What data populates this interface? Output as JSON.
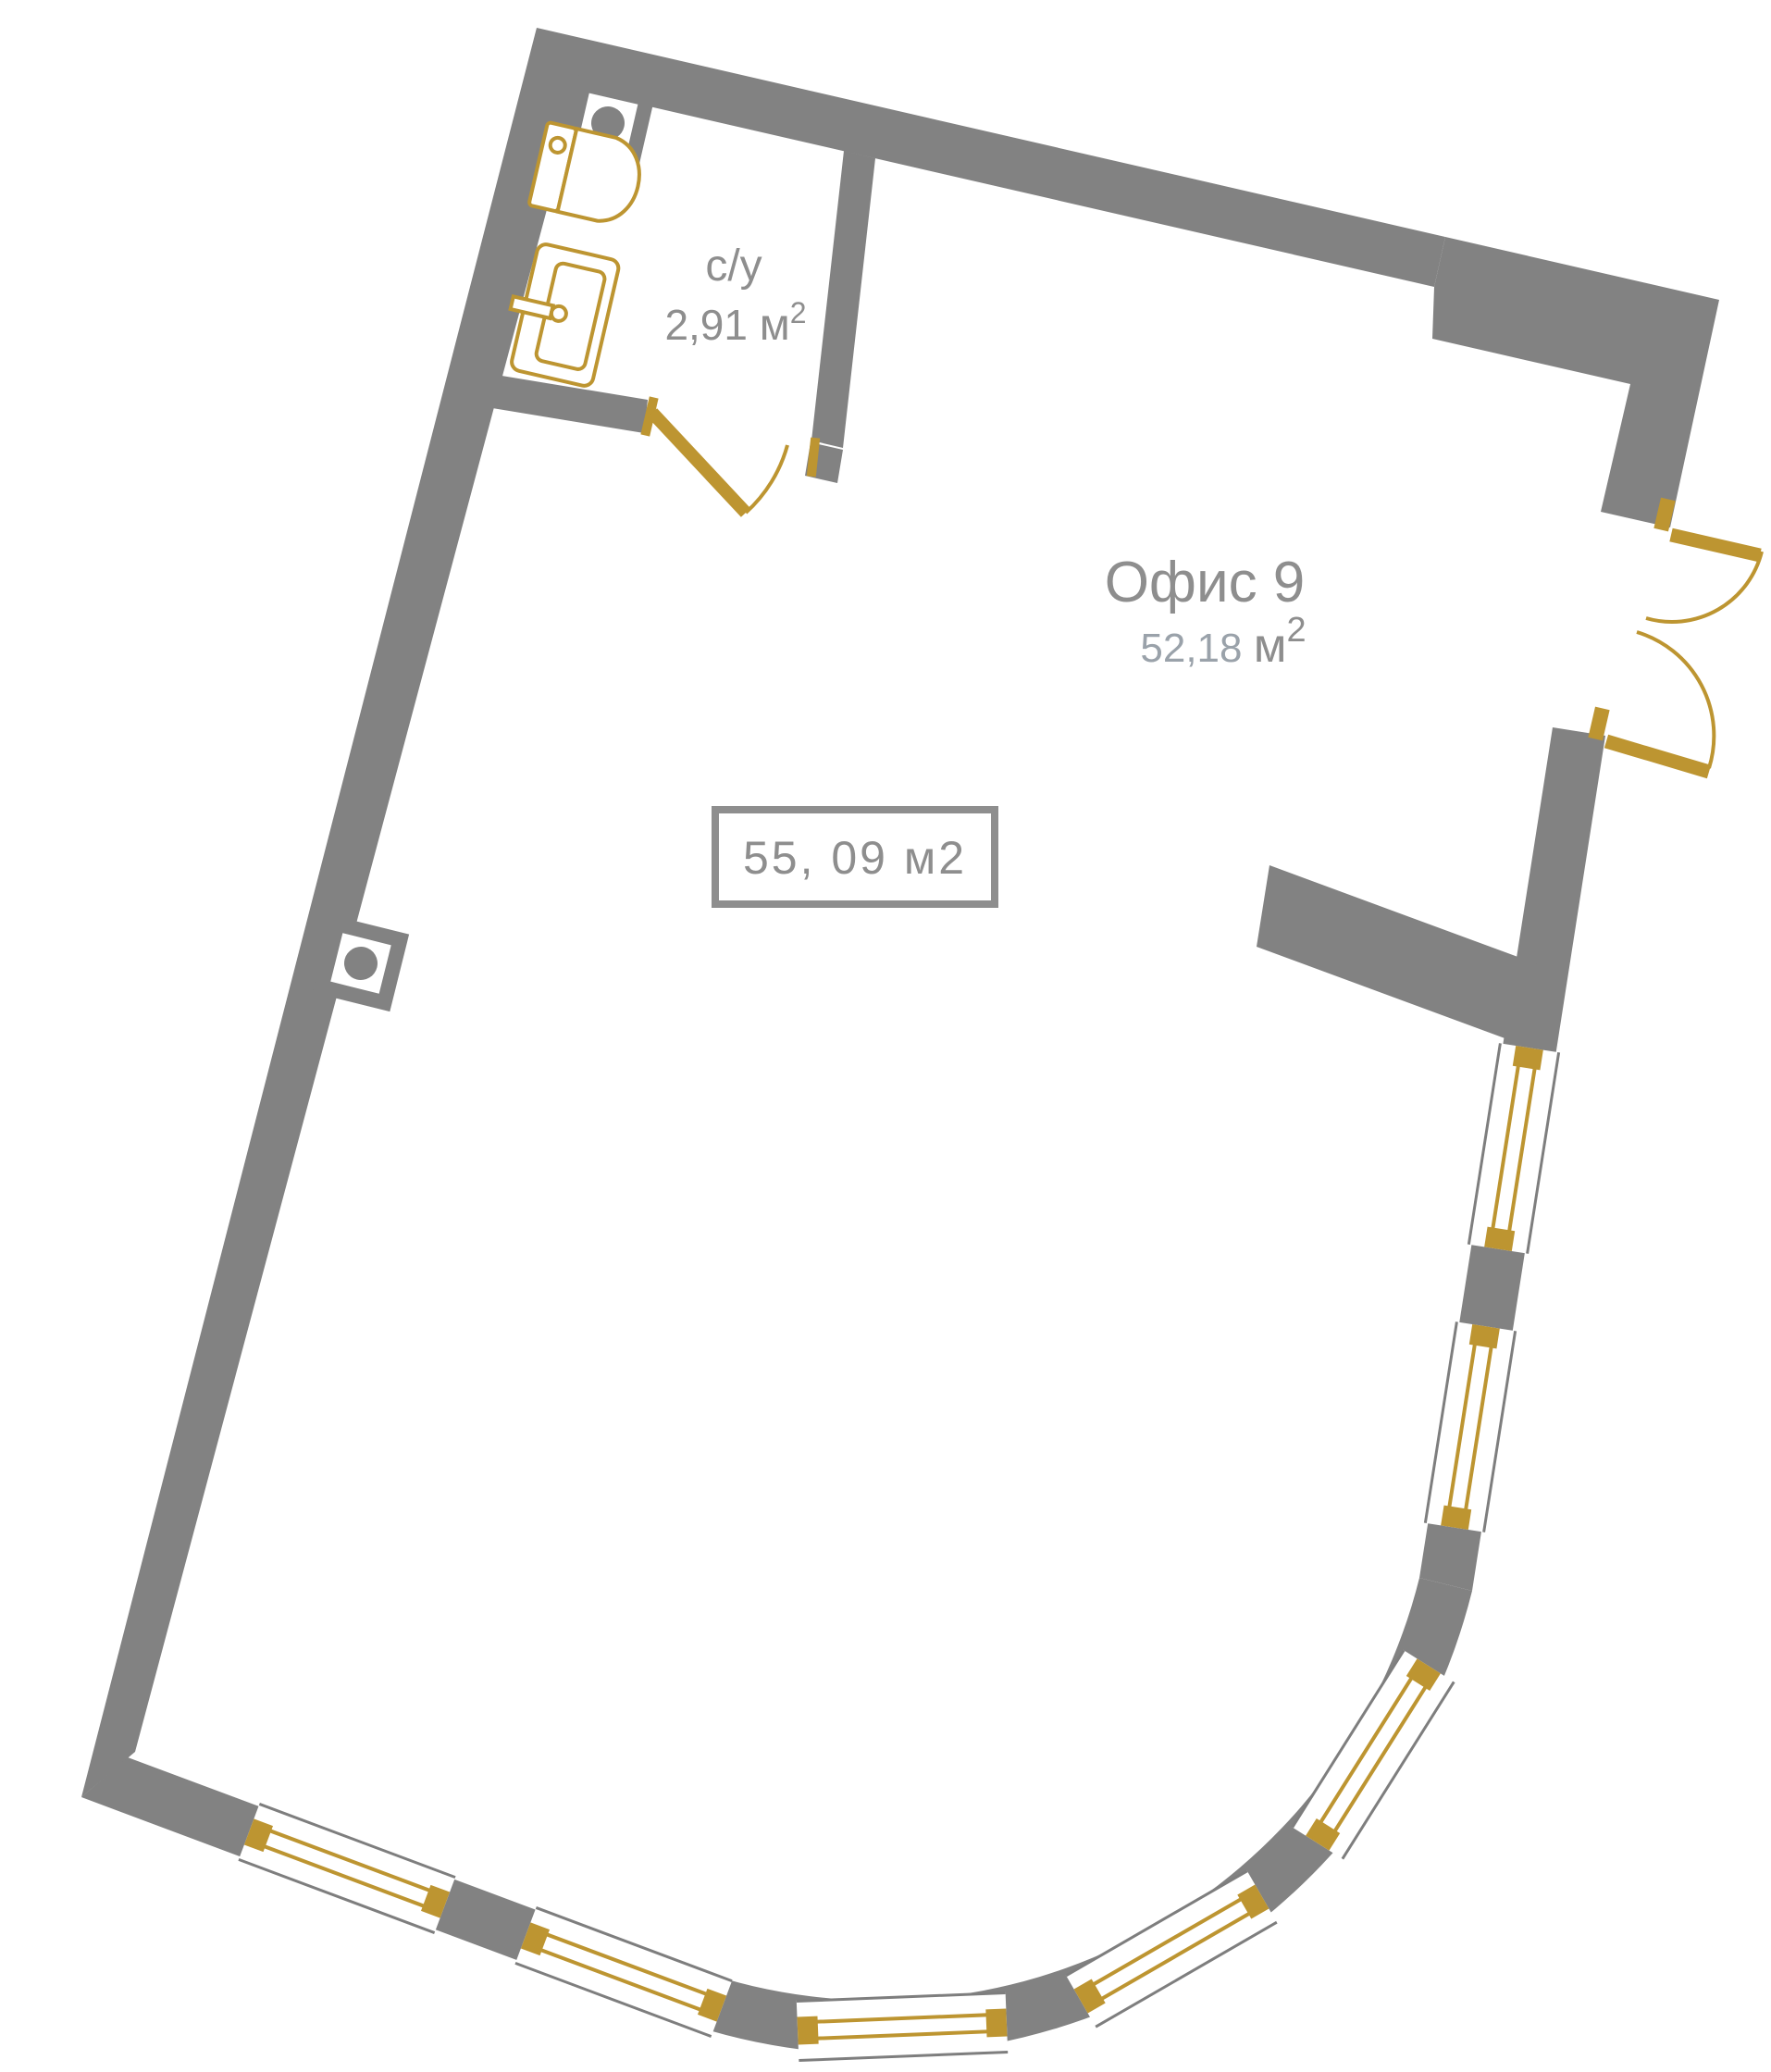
{
  "plan": {
    "office": {
      "name": "Офис 9",
      "area_value": "52,18",
      "area_unit": "м",
      "area_sup": "2"
    },
    "bathroom": {
      "name": "с/у",
      "area_value": "2,91",
      "area_unit": "м",
      "area_sup": "2"
    },
    "total_area_box": {
      "text": "55, 09 м2"
    }
  },
  "colors": {
    "wall": "#828282",
    "gold": "#BD9531",
    "label": "#8E8E8E",
    "area_light": "#9AA2AA",
    "line": "#7E7E7E"
  }
}
